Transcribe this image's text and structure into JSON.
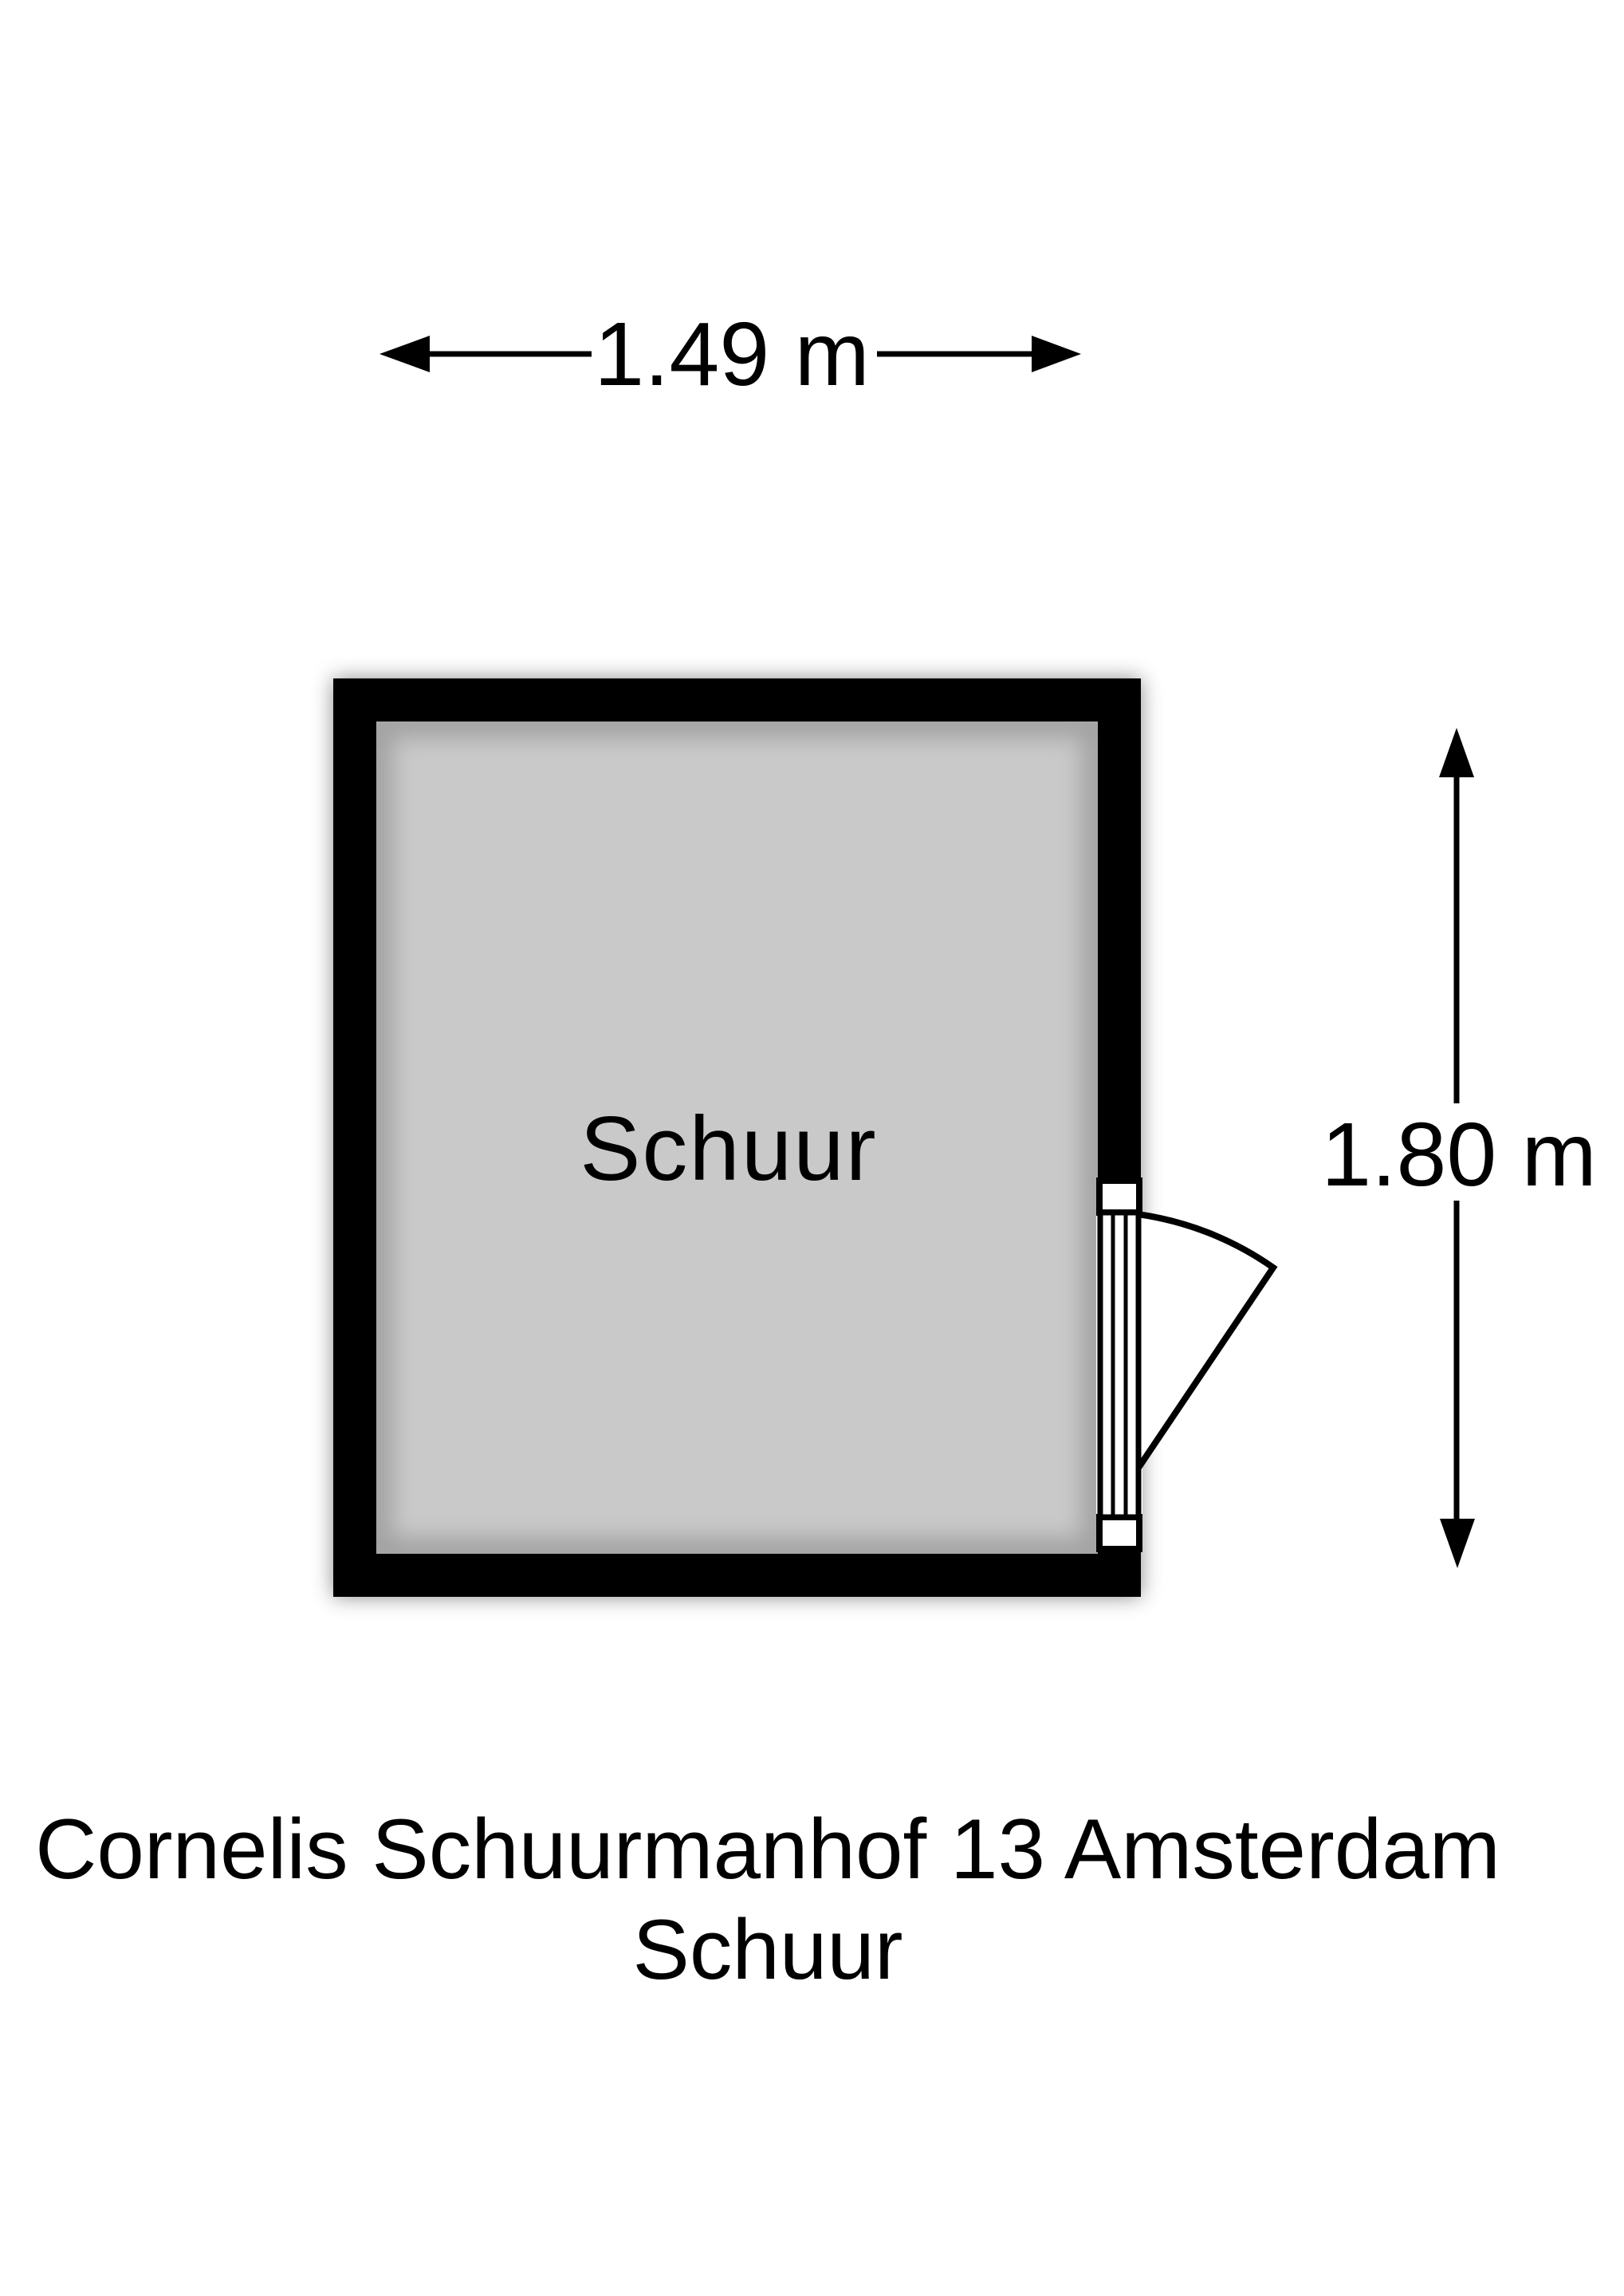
{
  "floorplan": {
    "room": {
      "label": "Schuur"
    },
    "dimensions": {
      "width": "1.49 m",
      "height": "1.80 m"
    },
    "caption": {
      "line1": "Cornelis Schuurmanhof 13 Amsterdam",
      "line2": "Schuur"
    },
    "colors": {
      "wall": "#000000",
      "floor": "#c9c9c9",
      "background": "#ffffff",
      "text": "#000000"
    }
  }
}
